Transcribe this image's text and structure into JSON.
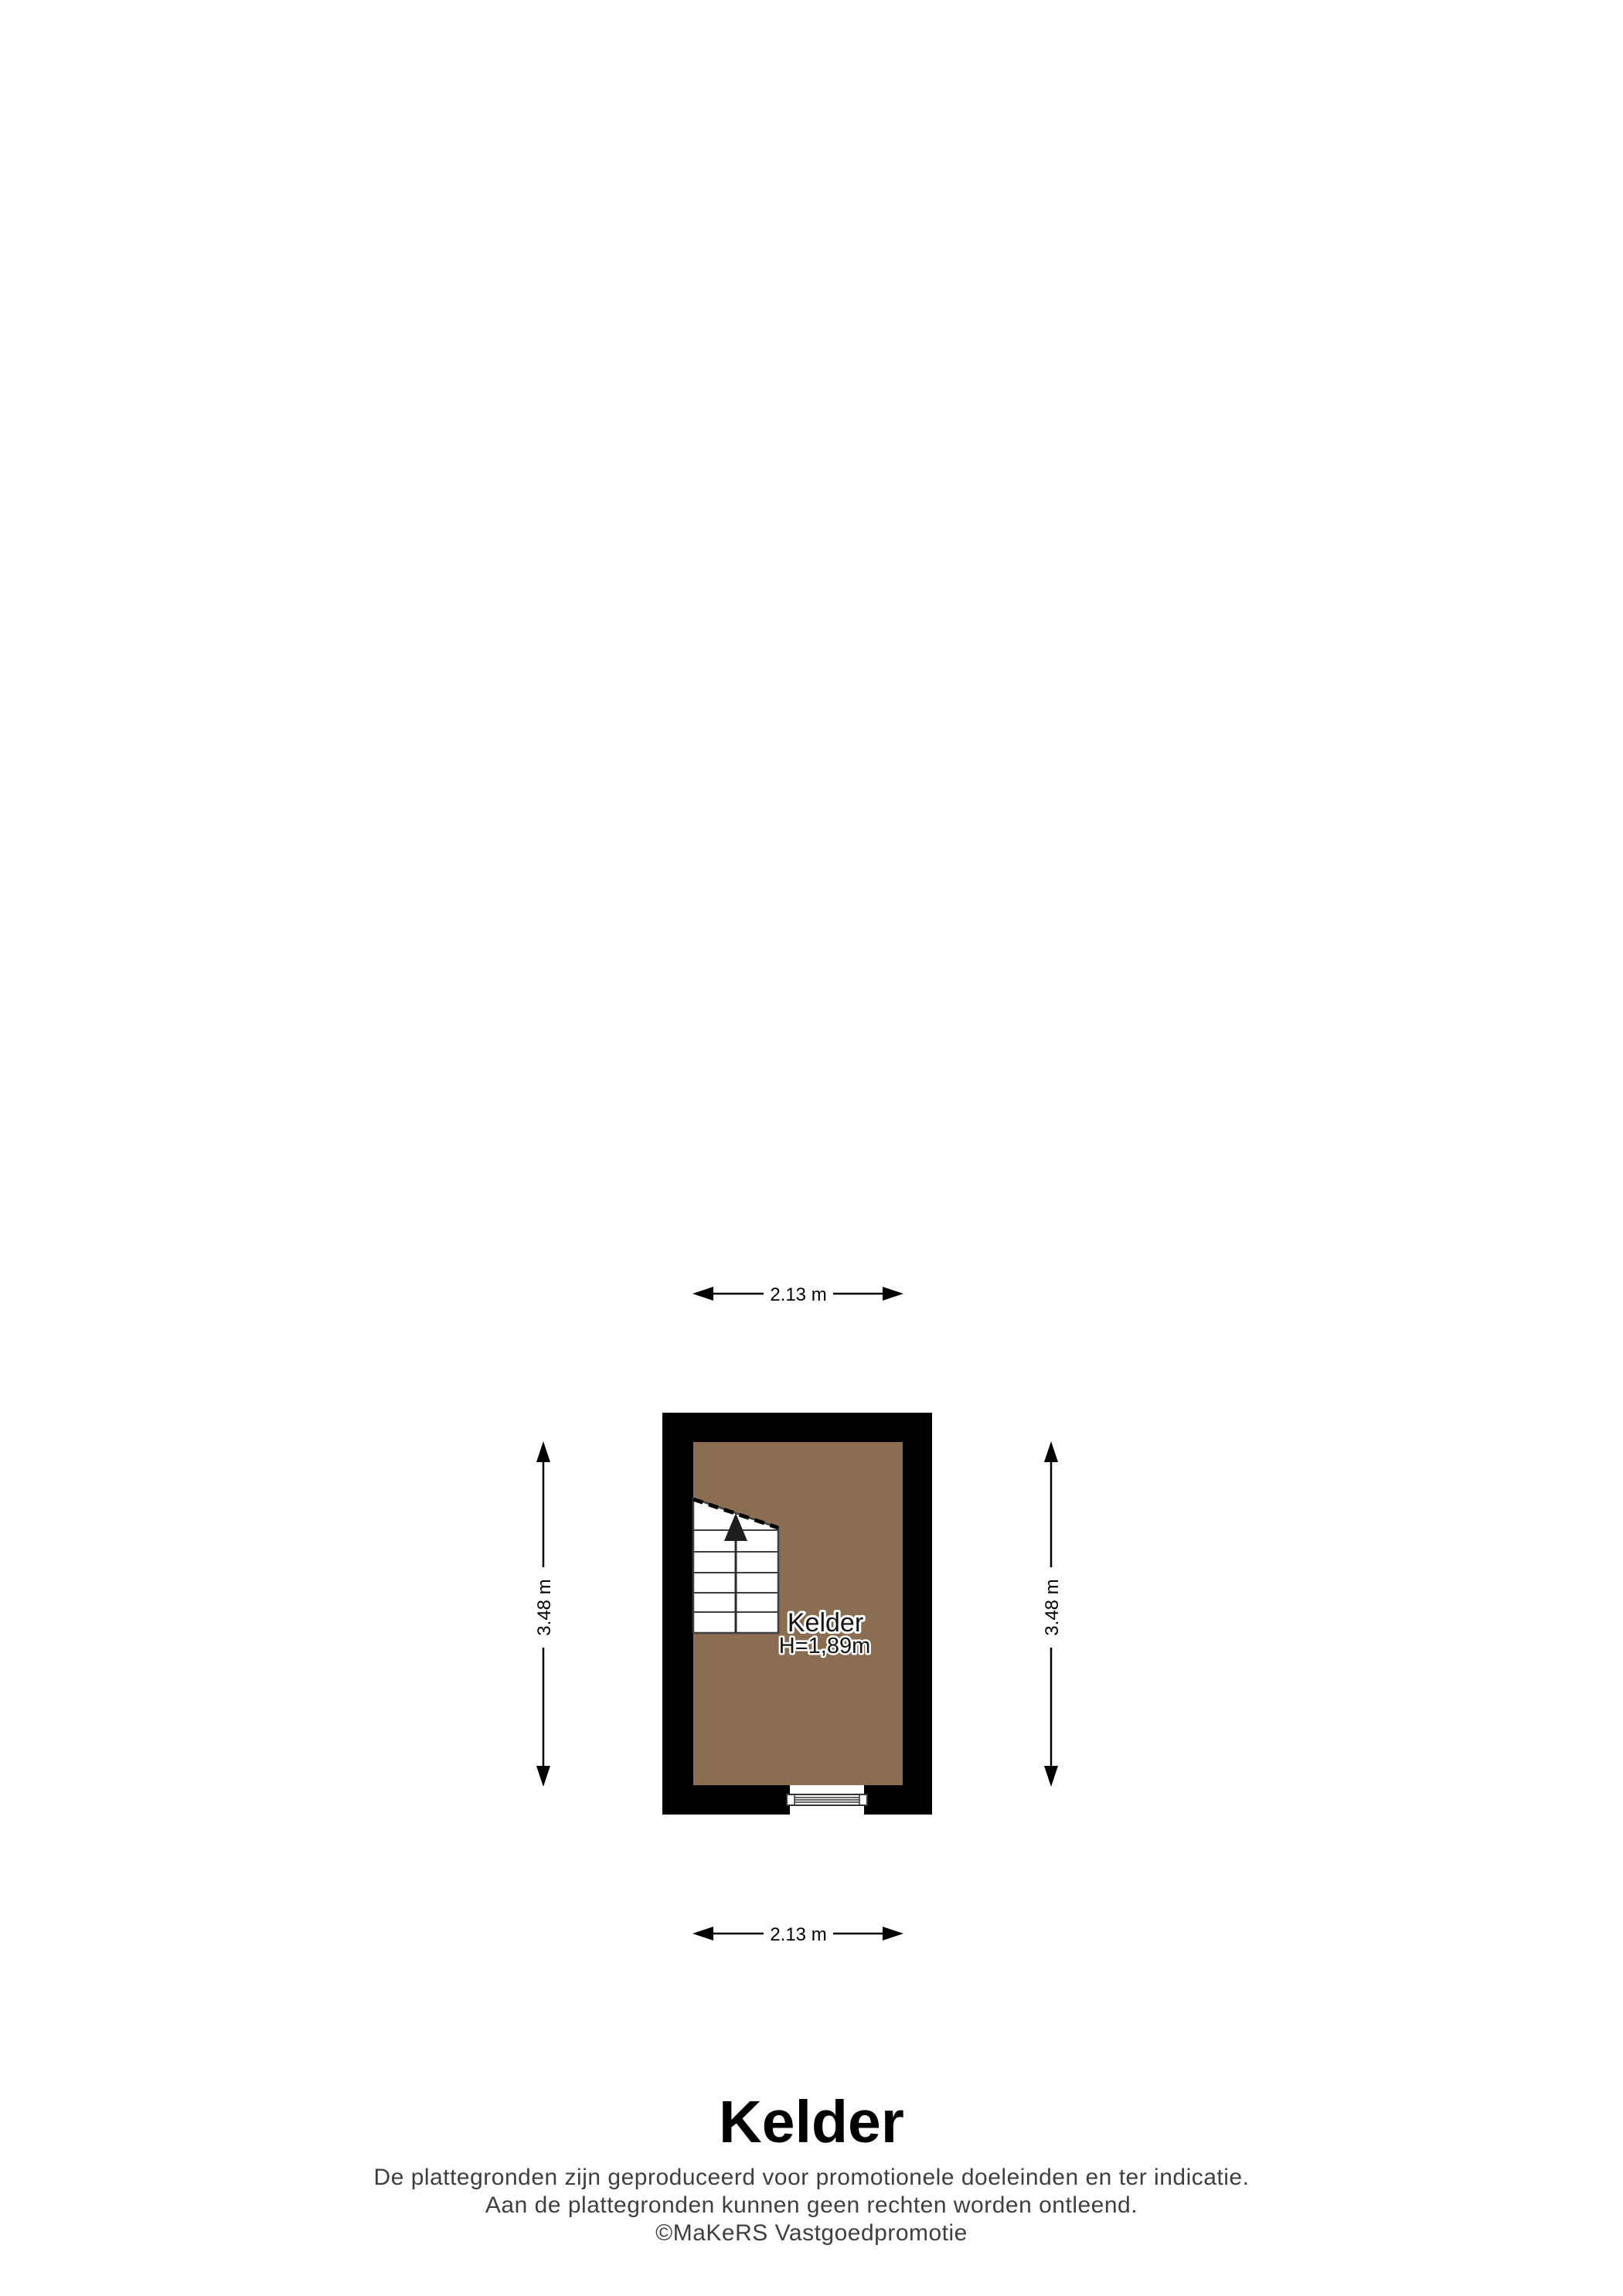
{
  "floorplan": {
    "room_label": "Kelder",
    "room_height_label": "H=1,89m",
    "floor_color": "#8B6E52",
    "wall_color": "#000000",
    "dimensions": {
      "top": "2.13 m",
      "bottom": "2.13 m",
      "left": "3.48 m",
      "right": "3.48 m"
    }
  },
  "footer": {
    "title": "Kelder",
    "disclaimer": [
      "De plattegronden zijn geproduceerd voor promotionele doeleinden en ter indicatie.",
      "Aan de plattegronden kunnen geen rechten worden ontleend.",
      "©MaKeRS Vastgoedpromotie"
    ]
  }
}
